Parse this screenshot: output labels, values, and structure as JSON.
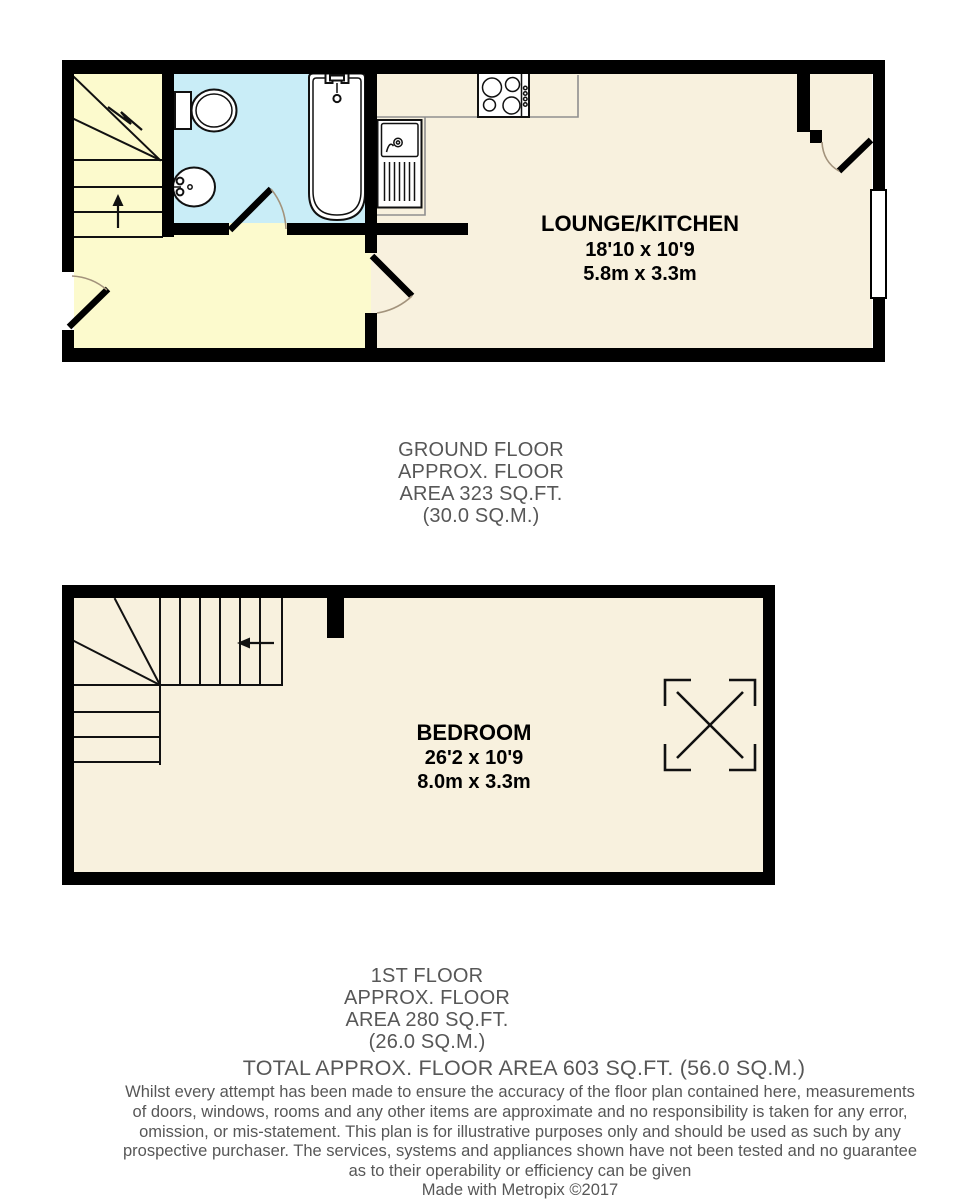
{
  "colors": {
    "wall": "#000000",
    "hall_floor": "#fcfacd",
    "bathroom_floor": "#c9edf7",
    "main_floor": "#f8f1de",
    "door_arc": "#a3937c",
    "label_gray": "#575757"
  },
  "ground_floor": {
    "room": {
      "name": "LOUNGE/KITCHEN",
      "size_imperial": "18'10 x 10'9",
      "size_metric": "5.8m x 3.3m"
    },
    "caption": [
      "GROUND FLOOR",
      "APPROX. FLOOR",
      "AREA 323 SQ.FT.",
      "(30.0 SQ.M.)"
    ]
  },
  "first_floor": {
    "room": {
      "name": "BEDROOM",
      "size_imperial": "26'2 x 10'9",
      "size_metric": "8.0m x 3.3m"
    },
    "caption": [
      "1ST FLOOR",
      "APPROX. FLOOR",
      "AREA 280 SQ.FT.",
      "(26.0 SQ.M.)"
    ]
  },
  "total_area_line": "TOTAL APPROX. FLOOR AREA 603 SQ.FT. (56.0 SQ.M.)",
  "disclaimer_lines": [
    "Whilst every attempt has been made to ensure the accuracy of the floor plan contained here, measurements",
    "of doors, windows, rooms and any other items are approximate and no responsibility is taken for any error,",
    "omission, or mis-statement. This plan is for illustrative purposes only and should be used as such by any",
    "prospective purchaser. The services, systems and appliances shown have not been tested and no guarantee",
    "as to their operability or efficiency can be given"
  ],
  "credit_line": "Made with Metropix ©2017"
}
